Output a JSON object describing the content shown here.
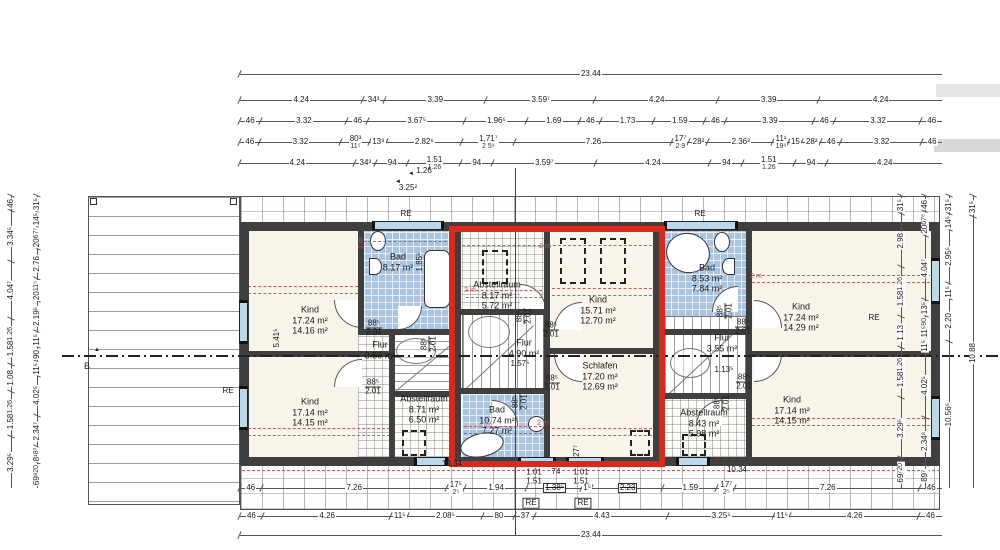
{
  "drawing": {
    "kind": "attic floor plan, three row-house units",
    "language": "de"
  },
  "overall": {
    "top": "23.44",
    "bottom": "23.44"
  },
  "dim_top_rows": [
    [
      "4.24",
      "34³",
      "3.39",
      "3.59⁷",
      "4.24",
      "3.39",
      "4.24"
    ],
    [
      "46",
      "3.32",
      "46",
      "3.67⁵",
      "1.96⁵",
      "1.69",
      "46",
      "1.73",
      "1.59",
      "46",
      "3.39",
      "46",
      "3.32",
      "46"
    ],
    [
      "46",
      "3.32",
      {
        "v": "80³",
        "sub": "11⁵"
      },
      "13⁹",
      "2.82⁶",
      {
        "v": "1,71⁷",
        "sub": "2 5⁹"
      },
      "7.26",
      {
        "v": "17⁷",
        "sub": "2 9"
      },
      "28²",
      "2.36³",
      {
        "v": "11¹",
        "sub": "19⁶"
      },
      "15",
      "28²",
      "46",
      "3.32",
      "46"
    ],
    [
      "4.24",
      "34³",
      "94",
      {
        "v": "1.51",
        "sub": "1.26"
      },
      "94",
      "3.59⁷",
      "4.24",
      "94",
      {
        "v": "1.51",
        "sub": "1.26"
      },
      "94",
      "4.24"
    ]
  ],
  "dim_bottom_rows": [
    [
      "46",
      "7.26",
      {
        "v": "17⁵",
        "sub": "2⁵"
      },
      "1.94",
      {
        "v": "1.38⁵",
        "box": true,
        "strike": true
      },
      "1⁵",
      {
        "v": "2.23",
        "box": true,
        "strike": true
      },
      "1.59",
      {
        "v": "17⁷",
        "sub": "2⁵"
      },
      "7.26",
      "46"
    ],
    [
      "46",
      "4.26",
      "11⁵",
      "2.08⁵",
      "80",
      "37",
      "4.43",
      "3.25⁵",
      "11⁵",
      "4.26",
      "46"
    ]
  ],
  "dim_left_cols": [
    [
      "46",
      "3.34⁵",
      "4.04⁷",
      {
        "v": "1.58",
        "sub": "1.26"
      },
      "1.08",
      {
        "v": "1.58",
        "sub": "1.26"
      },
      "3.29⁵"
    ],
    [
      "31⁵",
      "14⁵",
      {
        "v": "20",
        "sub": "67⁷"
      },
      "2.76",
      {
        "v": "20",
        "sub": "11⁵"
      },
      "2.19⁵",
      "11⁵",
      "90",
      "11⁵",
      "4.02⁵",
      "2.34⁷",
      {
        "v": "8¹",
        "sub": "8³"
      },
      {
        "v": "69⁸",
        "sub": "20"
      }
    ]
  ],
  "dim_right_cols": [
    [
      "31⁵",
      "2.98",
      {
        "v": "1.58",
        "sub": "1.26"
      },
      "1.13",
      {
        "v": "1.58",
        "sub": "1.26"
      },
      "3.29⁵",
      {
        "v": "69⁷",
        "sub": "20"
      }
    ],
    [
      "46",
      {
        "v": "20",
        "sub": "67⁸"
      },
      "4.04⁷",
      "13⁵",
      {
        "v": "11⁵",
        "sub": "90"
      },
      "11⁵",
      "4.02⁵",
      "2.34⁸",
      "89⁷"
    ],
    [
      "31⁵",
      "14⁵",
      "2.95⁵",
      "11⁵",
      "2.20",
      "10.56⁵"
    ],
    [
      "31⁵",
      "10.88"
    ]
  ],
  "rooms": [
    {
      "id": "left-bad",
      "name": "Bad",
      "lines": [
        "8.17 m²"
      ]
    },
    {
      "id": "left-kind-top",
      "name": "Kind",
      "lines": [
        "17.24 m²",
        "14.16 m²"
      ]
    },
    {
      "id": "left-flur",
      "name": "Flur",
      "lines": [
        "3.50 m²"
      ]
    },
    {
      "id": "left-kind-bottom",
      "name": "Kind",
      "lines": [
        "17.14 m²",
        "14.15 m²"
      ]
    },
    {
      "id": "left-abstellraum",
      "name": "Abstellraum",
      "lines": [
        "8.71 m²",
        "6.50 m²"
      ]
    },
    {
      "id": "mid-abstellraum",
      "name": "Abstellraum",
      "lines": [
        "8.17 m²",
        "5.72 m²"
      ]
    },
    {
      "id": "mid-kind",
      "name": "Kind",
      "lines": [
        "15.71 m²",
        "12.70 m²"
      ]
    },
    {
      "id": "mid-flur",
      "name": "Flur",
      "lines": [
        "4.90 m²"
      ]
    },
    {
      "id": "mid-schlafen",
      "name": "Schlafen",
      "lines": [
        "17.20 m²",
        "12.69 m²"
      ]
    },
    {
      "id": "mid-bad",
      "name": "Bad",
      "lines": [
        "10.74 m²",
        "7.27 m²"
      ]
    },
    {
      "id": "right-bad",
      "name": "Bad",
      "lines": [
        "8.53 m²",
        "7.84 m²"
      ]
    },
    {
      "id": "right-kind-top",
      "name": "Kind",
      "lines": [
        "17.24 m²",
        "14.29 m²"
      ]
    },
    {
      "id": "right-flur",
      "name": "Flur",
      "lines": [
        "3.55 m²"
      ]
    },
    {
      "id": "right-kind-bottom",
      "name": "Kind",
      "lines": [
        "17.14 m²",
        "14.15 m²"
      ]
    },
    {
      "id": "right-abstellraum",
      "name": "Abstellraum",
      "lines": [
        "8.43 m²",
        "5.98 m²"
      ]
    }
  ],
  "door_size": {
    "width": "88⁵",
    "height": "2.01"
  },
  "labels": [
    {
      "id": "re-top-left",
      "text": "RE"
    },
    {
      "id": "re-top-mid",
      "text": "RE"
    },
    {
      "id": "re-right",
      "text": "RE"
    },
    {
      "id": "re-terrace",
      "text": "RE"
    },
    {
      "id": "re-box-1",
      "text": "RE"
    },
    {
      "id": "re-box-2",
      "text": "RE"
    },
    {
      "id": "section-b",
      "text": "B"
    },
    {
      "id": "section-marker-icon",
      "text": "▲"
    },
    {
      "id": "dim-126",
      "text": "1.26"
    },
    {
      "id": "arrow-126-icon",
      "text": "◄"
    },
    {
      "id": "dim-3252",
      "text": "3.25²"
    },
    {
      "id": "arrow-3252-icon",
      "text": "◄"
    },
    {
      "id": "dim-5415",
      "text": "5.41⁵"
    },
    {
      "id": "dim-1855",
      "text": "1.85⁵"
    },
    {
      "id": "dim-1575",
      "text": "1.57⁵"
    },
    {
      "id": "dim-1135",
      "text": "1.13⁵"
    },
    {
      "id": "dim-277",
      "text": "27⁷"
    },
    {
      "id": "dim-1034-left",
      "text": "10.34"
    },
    {
      "id": "dim-1034-right",
      "text": "10.34"
    },
    {
      "id": "stack-101-left",
      "text": "1.01\n1.51"
    },
    {
      "id": "stack-74",
      "text": "74"
    },
    {
      "id": "stack-101-right",
      "text": "1.01\n1.51"
    },
    {
      "id": "height-2m-1",
      "text": "2 m"
    },
    {
      "id": "height-2m-2",
      "text": "2 m"
    },
    {
      "id": "height-2m-3",
      "text": "2 m"
    },
    {
      "id": "height-2m-4",
      "text": "2 m"
    },
    {
      "id": "height-2m-5",
      "text": "2 m"
    }
  ],
  "colors": {
    "highlight": "#d8291c",
    "tile_blue": "#a9c4e1",
    "wall": "#3f3f3f",
    "red_dashed": "#c0605c",
    "room_cream": "#f8f4e9"
  }
}
